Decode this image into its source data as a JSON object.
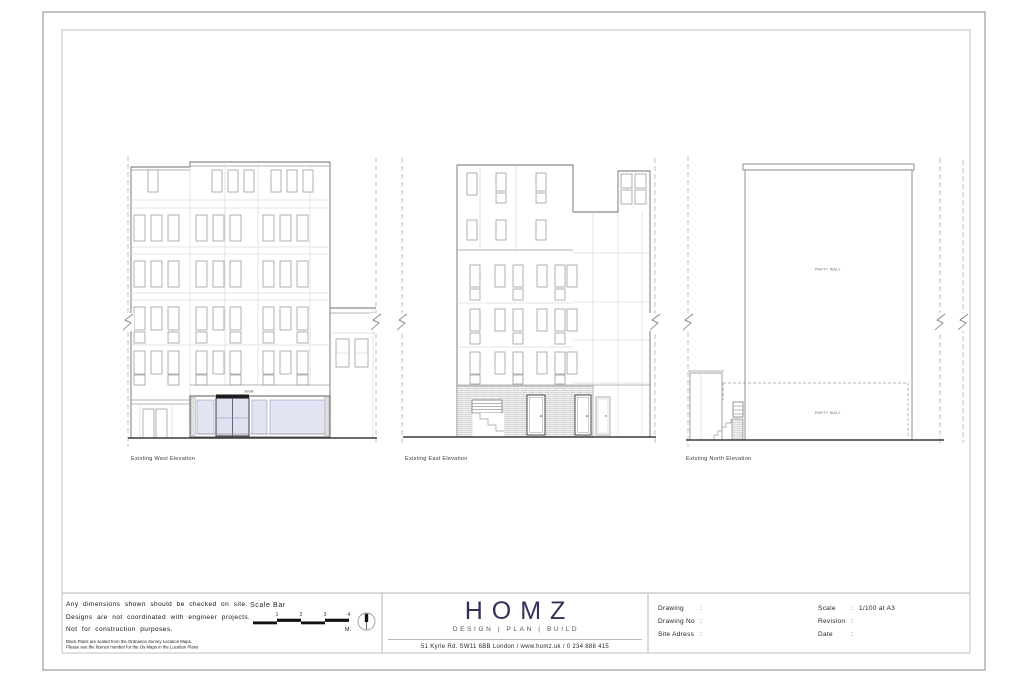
{
  "drawings": {
    "west": {
      "label": "Existing West Elevation",
      "fascia": "tenant"
    },
    "east": {
      "label": "Existing East Elevation"
    },
    "north": {
      "label": "Existing North Elevation",
      "party_wall_upper": "PARTY WALL",
      "party_wall_lower": "PARTY WALL"
    }
  },
  "title_block": {
    "notes": {
      "line1": "Any dimensions shown should be checked on site.",
      "line2": "Designs are not coordinated with engineer projects.",
      "line3": "Not for construction purposes.",
      "small1": "Block Plans are scaled from the Ordnance Survey Location Maps.",
      "small2": "Please see the licence number for the Os Maps in the Location Plans"
    },
    "scale_bar": {
      "title": "Scale Bar",
      "ticks": [
        "1",
        "2",
        "3",
        "4"
      ],
      "unit": "M."
    },
    "brand": {
      "name": "HOMZ",
      "tagline": "DESIGN | PLAN | BUILD",
      "address": "51 Kyrle Rd. SW11 6BB London / www.homz.uk / 0 234 888 415"
    },
    "info": {
      "colon": ":",
      "rows_left": [
        {
          "label": "Drawing",
          "value": ""
        },
        {
          "label": "Drawing No",
          "value": ""
        },
        {
          "label": "Site Adress",
          "value": ""
        }
      ],
      "rows_right": [
        {
          "label": "Scale",
          "value": "1/100 at A3"
        },
        {
          "label": "Revision",
          "value": ""
        },
        {
          "label": "Date",
          "value": ""
        }
      ]
    }
  },
  "colors": {
    "brand": "#34305a",
    "glazing": "#e2e4f3"
  }
}
